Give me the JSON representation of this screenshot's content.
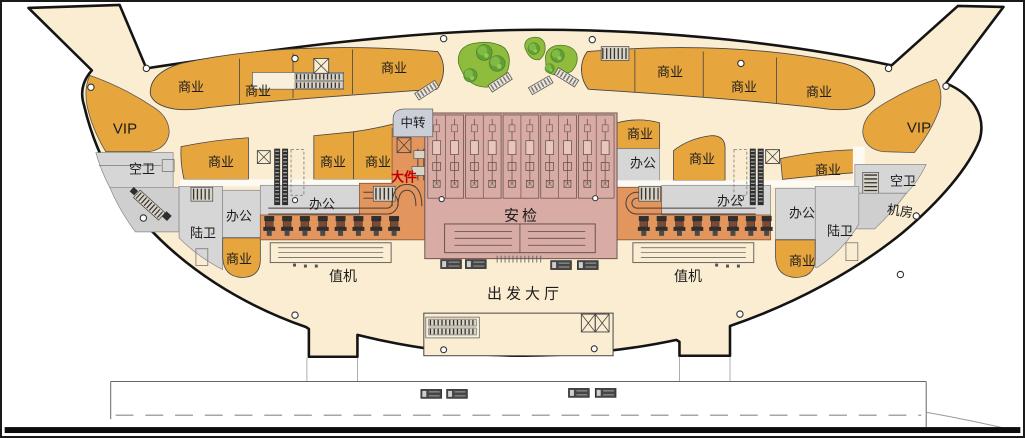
{
  "plan": {
    "type": "airport-terminal-departure-level-floor-plan",
    "labels": {
      "commercial": "商业",
      "vip": "VIP",
      "air_wc": "空卫",
      "land_wc": "陆卫",
      "office": "办公",
      "machine_room": "机房",
      "transfer": "中转",
      "oversize_baggage": "大件",
      "security_check": "安检",
      "check_in": "值机",
      "departure_hall": "出发大厅"
    },
    "colors": {
      "floor_cream": "#FAEDD2",
      "commercial_orange": "#E7A53E",
      "zone_gray": "#D6D6D6",
      "security_mauve": "#D8ACA4",
      "checkin_salmon": "#E2955C",
      "transfer_blue": "#C9CED7",
      "garden_green": "#8FBC3C",
      "tree_green": "#619E35",
      "outline_black": "#141414",
      "oversize_red": "#C00000"
    }
  }
}
